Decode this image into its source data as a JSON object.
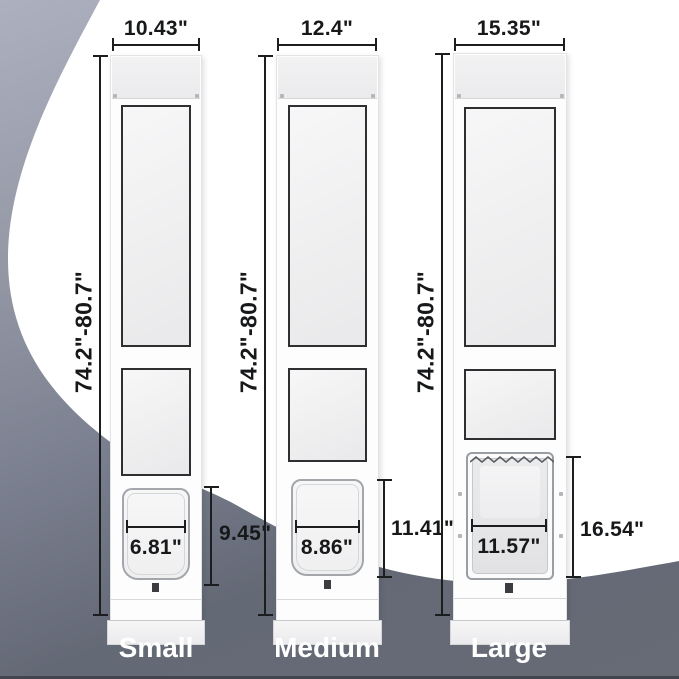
{
  "diagram_title": "Sliding door pet door size comparison",
  "shared": {
    "height_range_label": "74.2\"-80.7\""
  },
  "doors": [
    {
      "name": "Small",
      "width_label": "10.43\"",
      "height_label": "74.2\"-80.7\"",
      "flap_width_label": "6.81\"",
      "flap_height_label": "9.45\""
    },
    {
      "name": "Medium",
      "width_label": "12.4\"",
      "height_label": "74.2\"-80.7\"",
      "flap_width_label": "8.86\"",
      "flap_height_label": "11.41\""
    },
    {
      "name": "Large",
      "width_label": "15.35\"",
      "height_label": "74.2\"-80.7\"",
      "flap_width_label": "11.57\"",
      "flap_height_label": "16.54\""
    }
  ],
  "colors": {
    "background_top": "#adb0bf",
    "background_bottom": "#676b75",
    "spotlight": "#ffffff",
    "dimension_line": "#1c1d1f",
    "size_label_text": "#ffffff",
    "glass_frame": "#2e2f31"
  }
}
